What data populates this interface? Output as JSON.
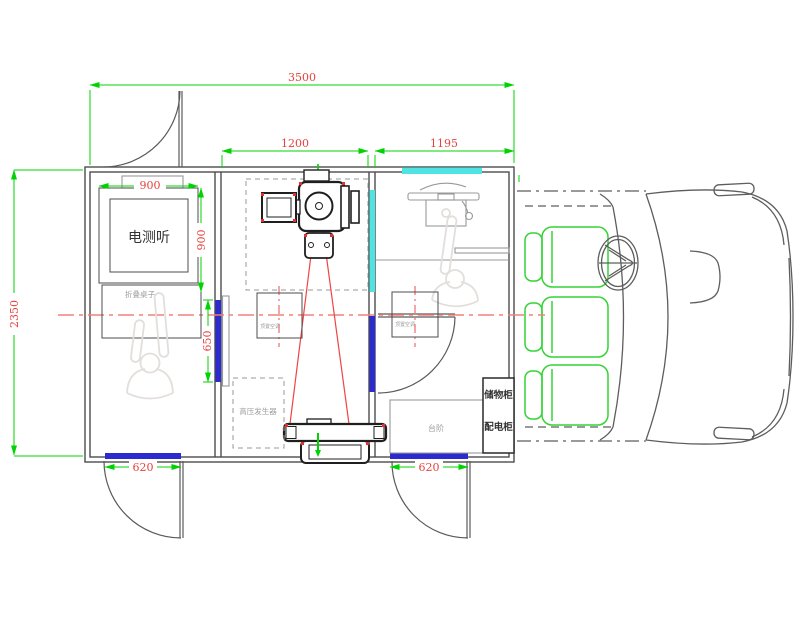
{
  "drawing": {
    "type": "vehicle-floor-plan",
    "description_visible_rooms": [
      "audiometry room",
      "x-ray room",
      "operator room",
      "cab"
    ]
  },
  "dimensions": {
    "total_length": "3500",
    "xray_room_width": "1200",
    "operator_room_width": "1195",
    "body_width": "2350",
    "audiometry_booth_width": "900",
    "audiometry_booth_depth": "900",
    "partition_window_width": "650",
    "left_door_width": "620",
    "right_door_width": "620"
  },
  "labels": {
    "audiometry_booth": "电测听",
    "folding_table": "折叠桌子",
    "hv_generator": "高压发生器",
    "roof_ac_left": "顶置空调",
    "roof_ac_right": "顶置空调",
    "steps": "台阶",
    "storage_cabinet": "储物柜",
    "power_cabinet": "配电柜"
  },
  "colors": {
    "dim_green": "#00d400",
    "dim_red": "#e8413c",
    "center_red": "#f0807a",
    "beam_red": "#ef4444",
    "door_blue": "#2b2bd0",
    "win_cyan": "#4fe3e2",
    "seat_green": "#35d435",
    "wall": "#4d4d4d",
    "equip": "#1f1f1f",
    "figure_gray": "#e2dedb"
  }
}
